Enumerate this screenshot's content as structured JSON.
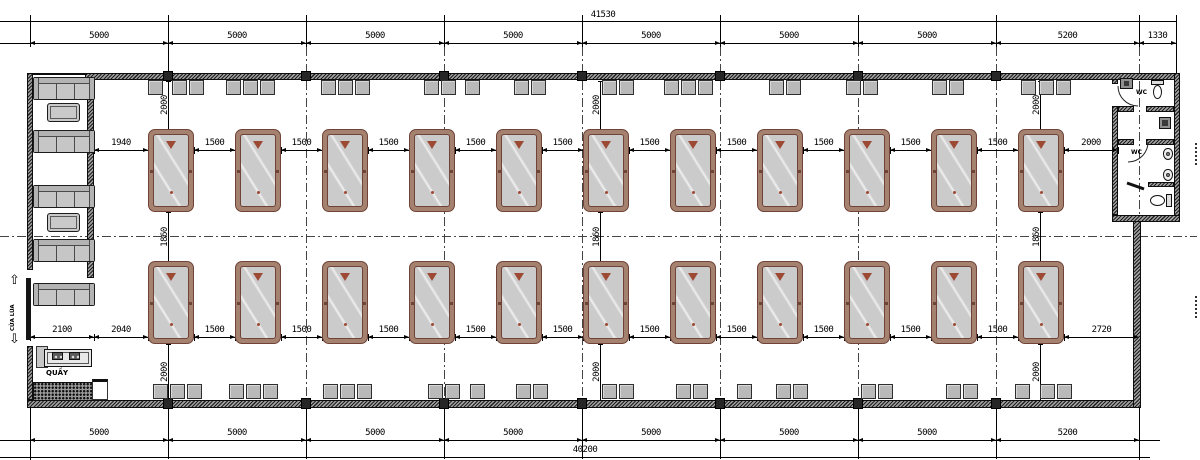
{
  "dimensions": {
    "top_total": "41530",
    "top_chain": [
      "5000",
      "5000",
      "5000",
      "5000",
      "5000",
      "5000",
      "5000",
      "5200",
      "1330"
    ],
    "bottom_chain": [
      "5000",
      "5000",
      "5000",
      "5000",
      "5000",
      "5000",
      "5000",
      "5200"
    ],
    "bottom_total": "40200",
    "upper_row_chain": [
      "1940",
      "1500",
      "1500",
      "1500",
      "1500",
      "1500",
      "1500",
      "1500",
      "1500",
      "1500",
      "1500",
      "2000"
    ],
    "lower_row_chain": [
      "2100",
      "2040",
      "1500",
      "1500",
      "1500",
      "1500",
      "1500",
      "1500",
      "1500",
      "1500",
      "1500",
      "1500",
      "2720"
    ],
    "vertical_top": "2000",
    "vertical_middle": "1860",
    "vertical_bottom": "2000"
  },
  "labels": {
    "counter": "QUẦY",
    "sliding_door": "CỬA LÙA",
    "wc_room_1": "WC",
    "wc_room_2": "WC"
  },
  "furniture": {
    "pool_table_rows": 2,
    "pool_tables_per_row": 11,
    "sofas": 5,
    "coffee_tables": 2,
    "toilets": 2,
    "urinals": 2,
    "sinks": 2,
    "lounge_items": [
      {
        "t": "sofa",
        "y": 77
      },
      {
        "t": "ctable",
        "y": 103
      },
      {
        "t": "sofa",
        "y": 130
      },
      {
        "t": "sofa",
        "y": 185
      },
      {
        "t": "ctable",
        "y": 213
      },
      {
        "t": "sofa",
        "y": 239
      },
      {
        "t": "sofa",
        "y": 283
      }
    ],
    "stool_groups_top": [
      {
        "x": 155,
        "n": 1
      },
      {
        "x": 188,
        "n": 2
      },
      {
        "x": 250,
        "n": 3
      },
      {
        "x": 345,
        "n": 3
      },
      {
        "x": 440,
        "n": 2
      },
      {
        "x": 472,
        "n": 1
      },
      {
        "x": 530,
        "n": 2
      },
      {
        "x": 618,
        "n": 2
      },
      {
        "x": 688,
        "n": 3
      },
      {
        "x": 785,
        "n": 2
      },
      {
        "x": 862,
        "n": 2
      },
      {
        "x": 948,
        "n": 2
      },
      {
        "x": 1028,
        "n": 1
      },
      {
        "x": 1055,
        "n": 2
      }
    ],
    "stool_groups_bottom": [
      {
        "x": 177,
        "n": 3
      },
      {
        "x": 253,
        "n": 3
      },
      {
        "x": 347,
        "n": 3
      },
      {
        "x": 444,
        "n": 2
      },
      {
        "x": 477,
        "n": 1
      },
      {
        "x": 532,
        "n": 2
      },
      {
        "x": 618,
        "n": 2
      },
      {
        "x": 692,
        "n": 2
      },
      {
        "x": 744,
        "n": 1
      },
      {
        "x": 792,
        "n": 2
      },
      {
        "x": 877,
        "n": 2
      },
      {
        "x": 962,
        "n": 2
      },
      {
        "x": 1022,
        "n": 1
      },
      {
        "x": 1056,
        "n": 2
      }
    ]
  },
  "colors": {
    "table_rail": "#a5826f",
    "table_border": "#6f4337",
    "table_felt": "#cbcbcb",
    "accent": "#9c4a33",
    "stool": "#b9b9b9"
  }
}
